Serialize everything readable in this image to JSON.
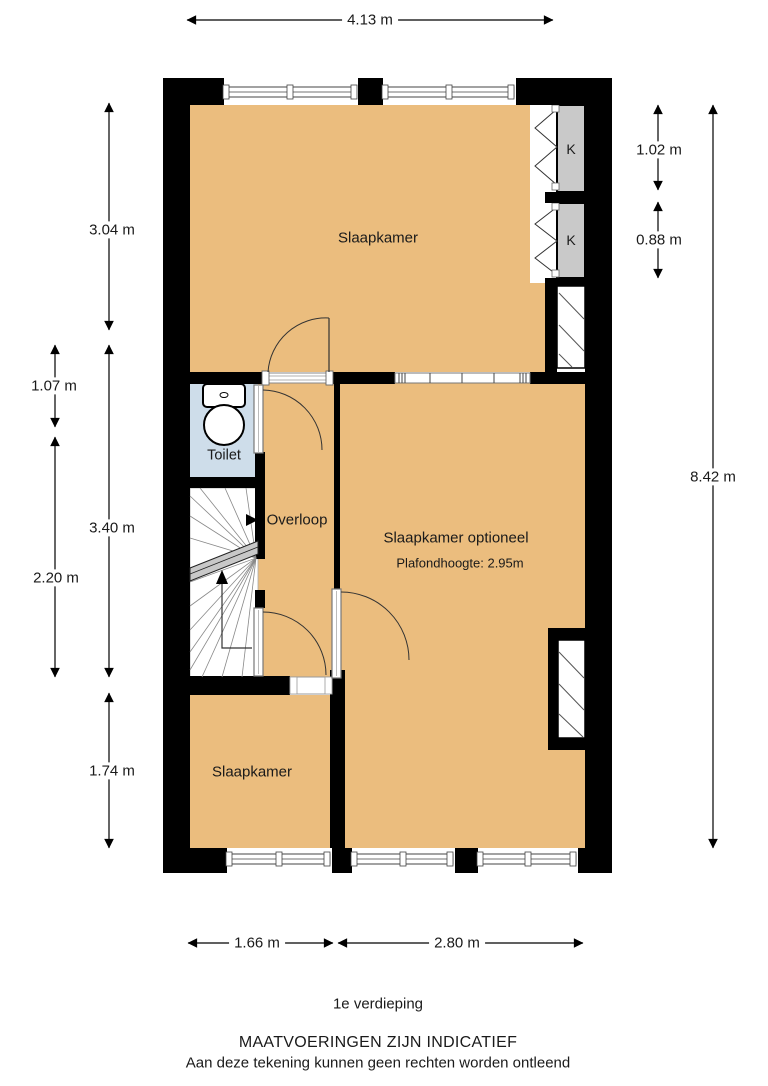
{
  "floorplan": {
    "floor_title": "1e verdieping",
    "disclaimer_line1": "MAATVOERINGEN ZIJN INDICATIEF",
    "disclaimer_line2": "Aan deze tekening kunnen geen rechten worden ontleend",
    "rooms": {
      "bedroom_top": "Slaapkamer",
      "bedroom_optional": "Slaapkamer optioneel",
      "bedroom_optional_note": "Plafondhoogte: 2.95m",
      "bedroom_bottom": "Slaapkamer",
      "landing": "Overloop",
      "toilet": "Toilet",
      "closet_1": "K",
      "closet_2": "K"
    },
    "dimensions": {
      "top_width": "4.13 m",
      "left_bedroom_top": "3.04 m",
      "left_toilet": "1.07 m",
      "left_landing": "3.40 m",
      "left_stairs": "2.20 m",
      "left_bedroom_bottom": "1.74 m",
      "right_total_depth": "8.42 m",
      "closet_1_height": "1.02 m",
      "closet_2_height": "0.88 m",
      "bottom_left_width": "1.66 m",
      "bottom_right_width": "2.80 m"
    },
    "colors": {
      "room_fill": "#EBBD7E",
      "toilet_fill": "#CEDDEA",
      "closet_fill": "#C9C9C9",
      "wall": "#000000",
      "background": "#FFFFFF"
    }
  }
}
